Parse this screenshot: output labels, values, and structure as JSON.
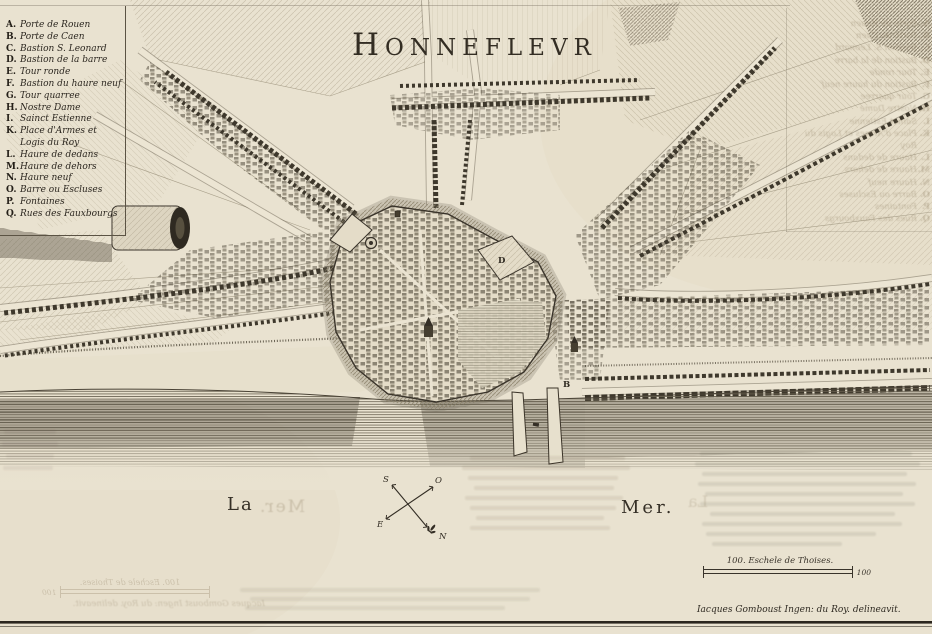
{
  "title": "HONNEFLEVR",
  "legend": {
    "items": [
      {
        "letter": "A.",
        "label": "Porte de Rouen"
      },
      {
        "letter": "B.",
        "label": "Porte de Caen"
      },
      {
        "letter": "C.",
        "label": "Bastion S. Leonard"
      },
      {
        "letter": "D.",
        "label": "Bastion de la barre"
      },
      {
        "letter": "E.",
        "label": "Tour ronde"
      },
      {
        "letter": "F.",
        "label": "Bastion du haure neuf"
      },
      {
        "letter": "G.",
        "label": "Tour quarree"
      },
      {
        "letter": "H.",
        "label": "Nostre Dame"
      },
      {
        "letter": "I.",
        "label": "Sainct Estienne"
      },
      {
        "letter": "K.",
        "label": "Place d'Armes et Logis du Roy"
      },
      {
        "letter": "L.",
        "label": "Haure de dedans"
      },
      {
        "letter": "M.",
        "label": "Haure de dehors"
      },
      {
        "letter": "N.",
        "label": "Haure neuf"
      },
      {
        "letter": "O.",
        "label": "Barre ou Escluses"
      },
      {
        "letter": "P.",
        "label": "Fontaines"
      },
      {
        "letter": "Q.",
        "label": "Rues des Fauxbourgs"
      }
    ]
  },
  "sea": {
    "la": "La",
    "mer": "Mer."
  },
  "compass": {
    "s": "S",
    "o": "O",
    "e": "E",
    "n": "N"
  },
  "scale": {
    "caption": "100. Eschele de Thoises.",
    "end_value": "100"
  },
  "credit": "Iacques Gomboust Ingen: du Roy. delineavit.",
  "markers": {
    "d": "D",
    "b": "B"
  },
  "colors": {
    "paper": "#e9e2d0",
    "ink": "#39332a",
    "water_line": "#6b6453"
  }
}
